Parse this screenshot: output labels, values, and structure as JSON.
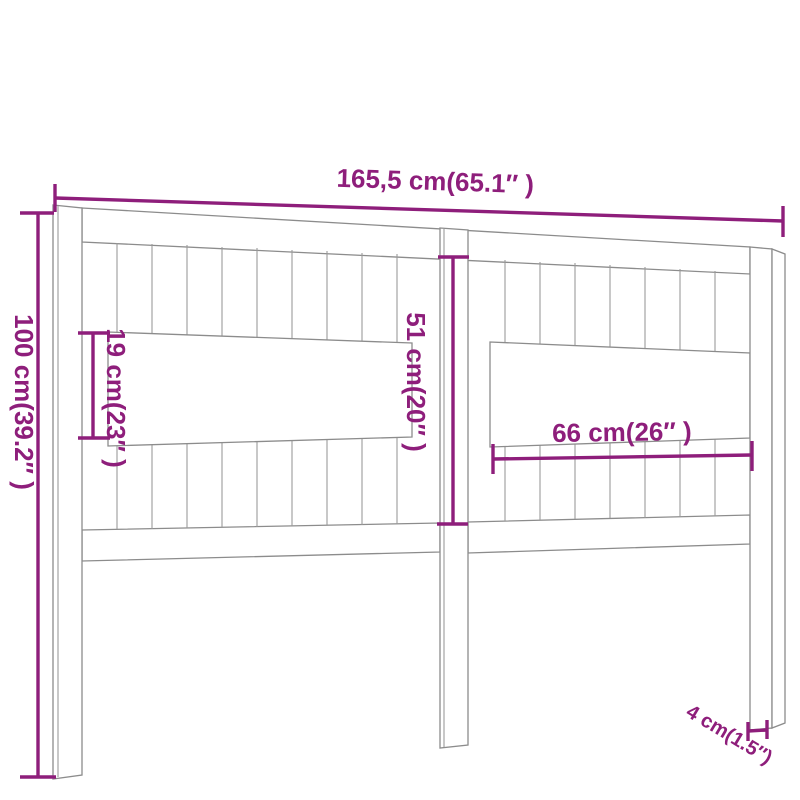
{
  "diagram": {
    "subject": "headboard-dimension-diagram",
    "colors": {
      "dimension_annotation": "#8e1e7b",
      "drawing_outline": "#8c8c8c",
      "background": "#ffffff"
    },
    "labels": {
      "overall_width": "165,5 cm(65.1″ )",
      "overall_height": "100 cm(39.2″ )",
      "left_opening_height": "19 cm(23″ )",
      "inner_height": "51 cm(20″ )",
      "right_opening_width": "66 cm(26″ )",
      "leg_thickness": "4 cm(1.5″)"
    },
    "values": {
      "overall_width_cm": "165,5",
      "overall_height_cm": "100",
      "left_opening_height_cm": "19",
      "inner_height_cm": "51",
      "right_opening_width_cm": "66",
      "leg_thickness_cm": "4"
    }
  }
}
